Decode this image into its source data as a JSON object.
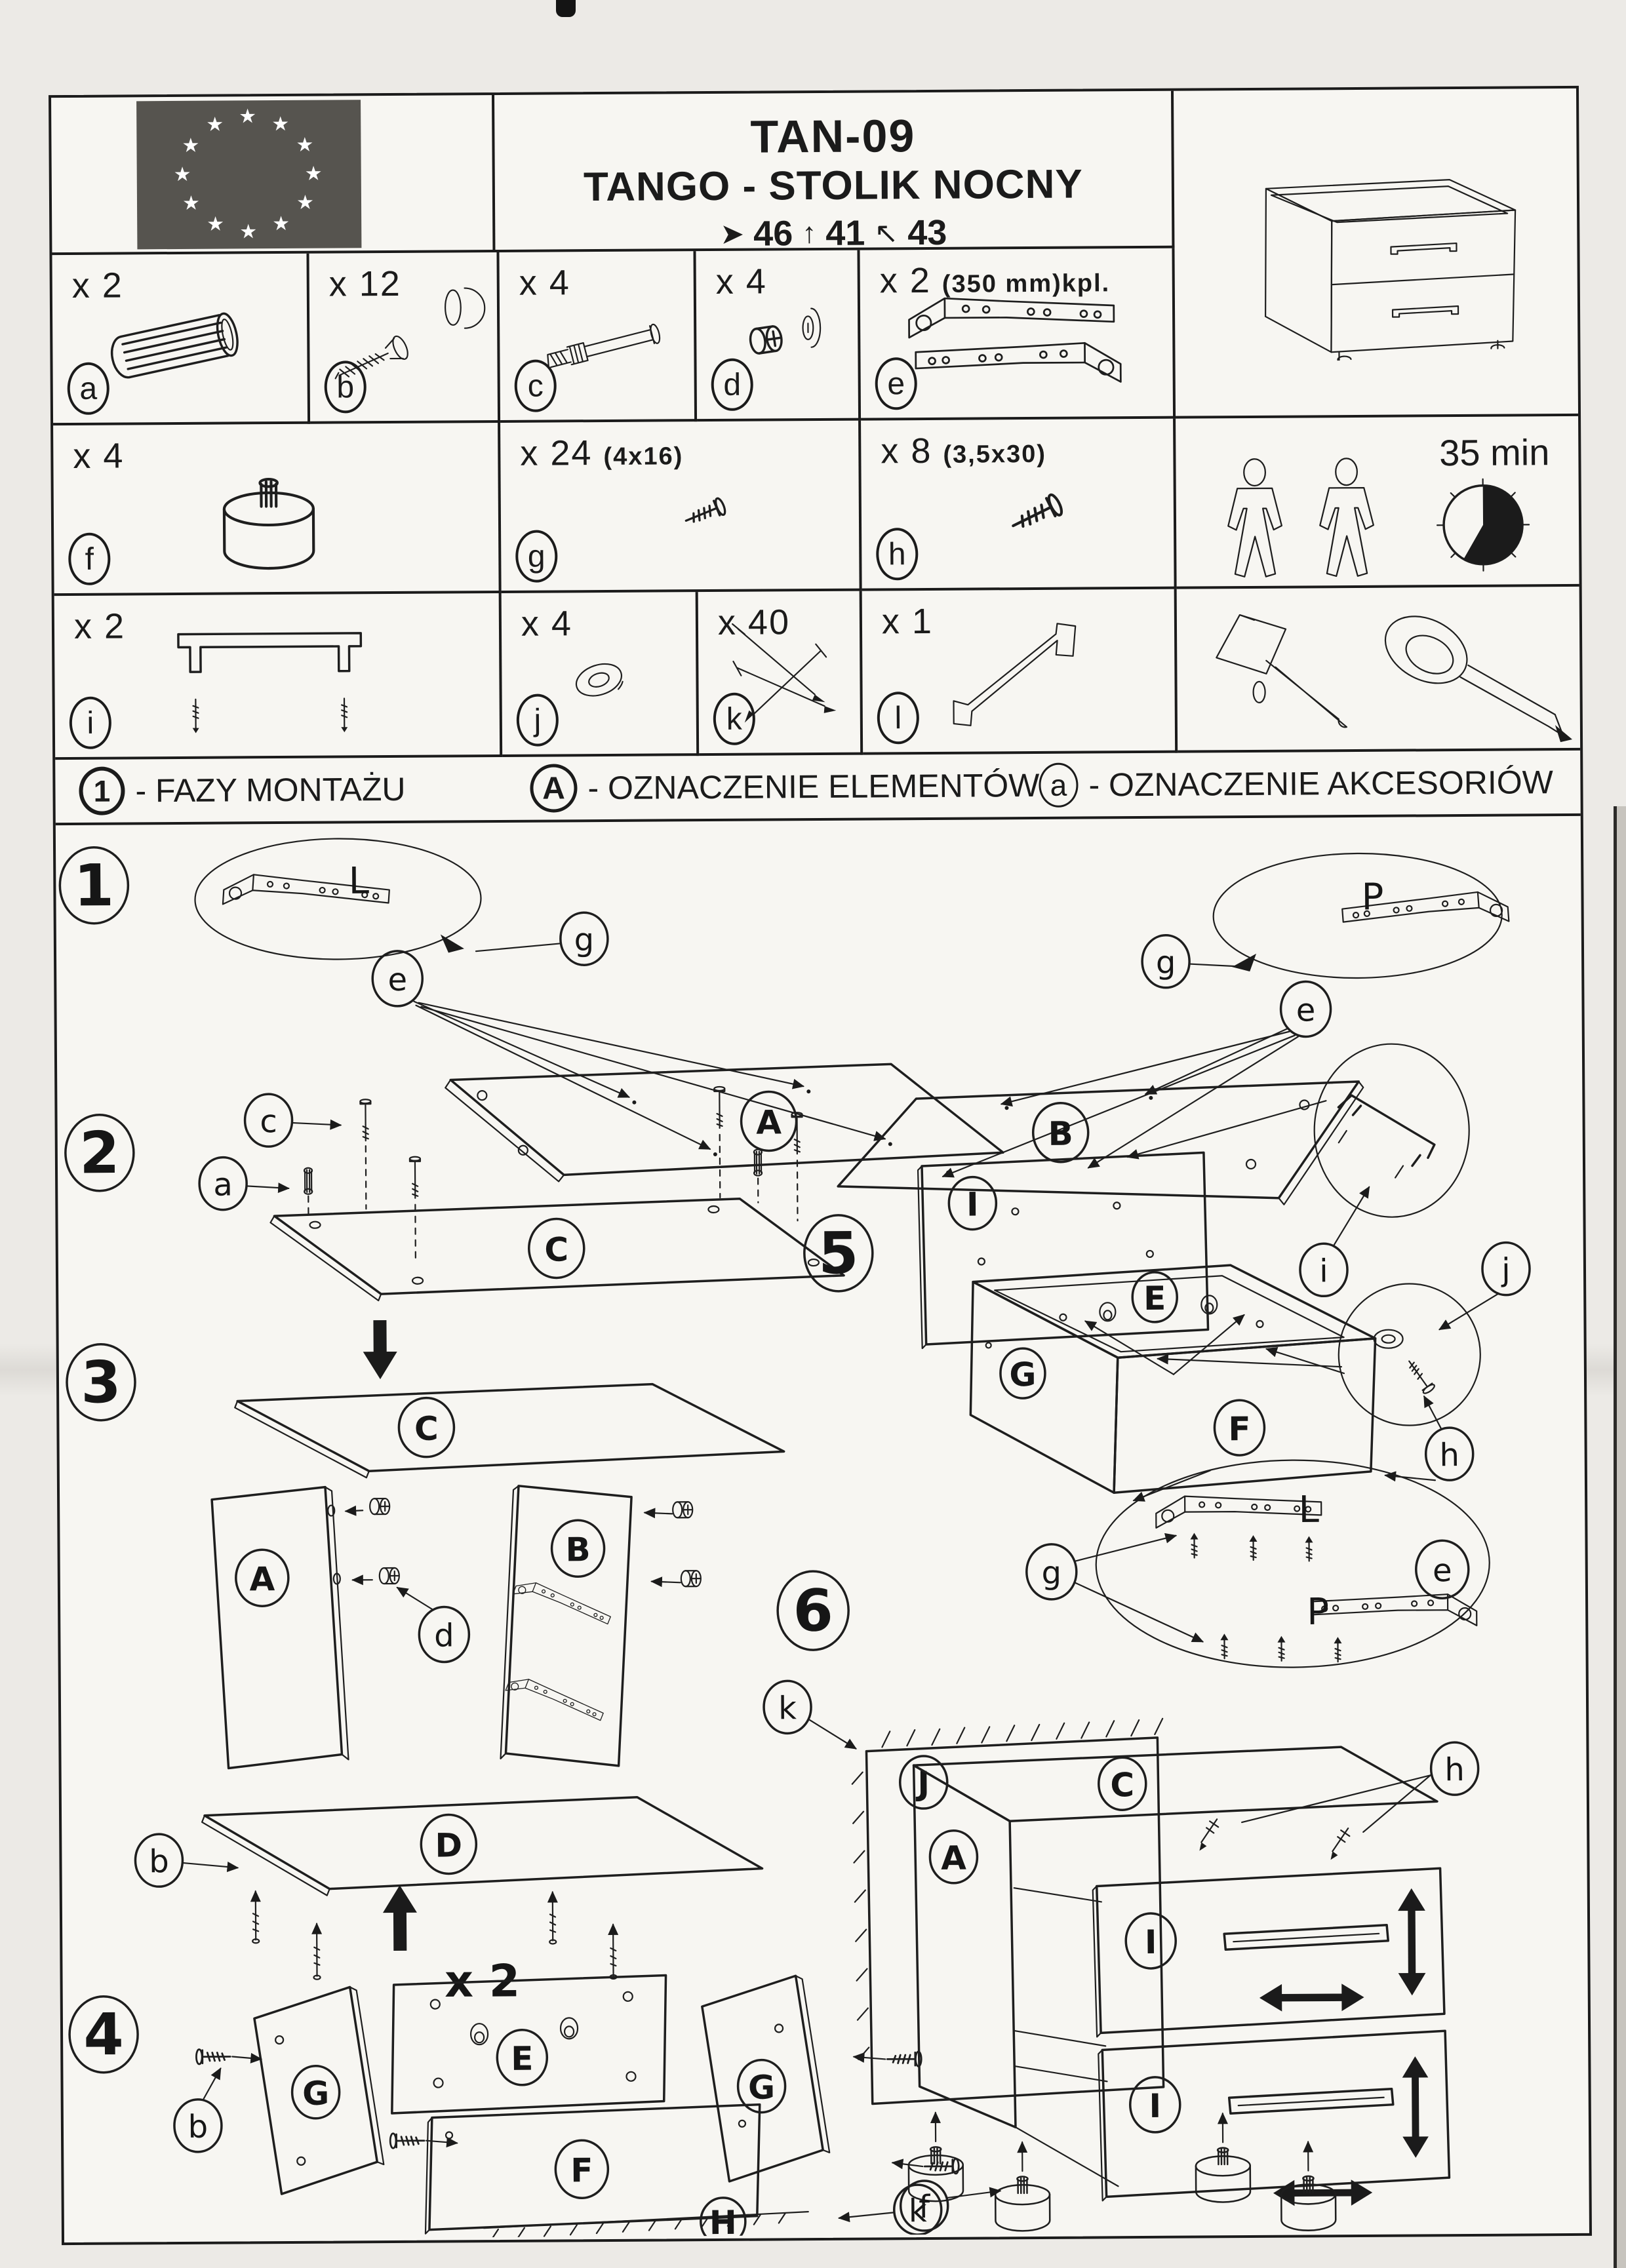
{
  "document": {
    "code": "TAN-09",
    "title": "TANGO - STOLIK NOCNY",
    "assembly_time": "35 min",
    "dimensions": {
      "width": "46",
      "height": "41",
      "depth": "43"
    }
  },
  "parts": {
    "a": {
      "id": "a",
      "qty": "x 2"
    },
    "b": {
      "id": "b",
      "qty": "x 12"
    },
    "c": {
      "id": "c",
      "qty": "x 4"
    },
    "d": {
      "id": "d",
      "qty": "x 4"
    },
    "e": {
      "id": "e",
      "qty": "x 2",
      "size": "(350 mm)kpl."
    },
    "f": {
      "id": "f",
      "qty": "x 4"
    },
    "g": {
      "id": "g",
      "qty": "x 24",
      "size": "(4x16)"
    },
    "h": {
      "id": "h",
      "qty": "x 8",
      "size": "(3,5x30)"
    },
    "i": {
      "id": "i",
      "qty": "x 2"
    },
    "j": {
      "id": "j",
      "qty": "x 4"
    },
    "k": {
      "id": "k",
      "qty": "x 40"
    },
    "l": {
      "id": "l",
      "qty": "x 1"
    }
  },
  "legend": {
    "phases": {
      "symbol": "1",
      "label": "- FAZY MONTAŻU"
    },
    "elements": {
      "symbol": "A",
      "label": "- OZNACZENIE ELEMENTÓW"
    },
    "accessories": {
      "symbol": "a",
      "label": "- OZNACZENIE AKCESORIÓW"
    }
  },
  "steps": {
    "s1": "1",
    "s2": "2",
    "s3": "3",
    "s4": "4",
    "s5": "5",
    "s6": "6"
  },
  "step4_qty": "x 2",
  "panels": {
    "A": "A",
    "B": "B",
    "C": "C",
    "D": "D",
    "E": "E",
    "F": "F",
    "G": "G",
    "H": "H",
    "I": "I",
    "J": "J"
  },
  "slide_marks": {
    "left": "L",
    "right": "P"
  },
  "icons": {
    "star": "★",
    "dim_width_arrow": "➤",
    "dim_height_arrow": "↑",
    "dim_depth_arrow": "↖"
  }
}
